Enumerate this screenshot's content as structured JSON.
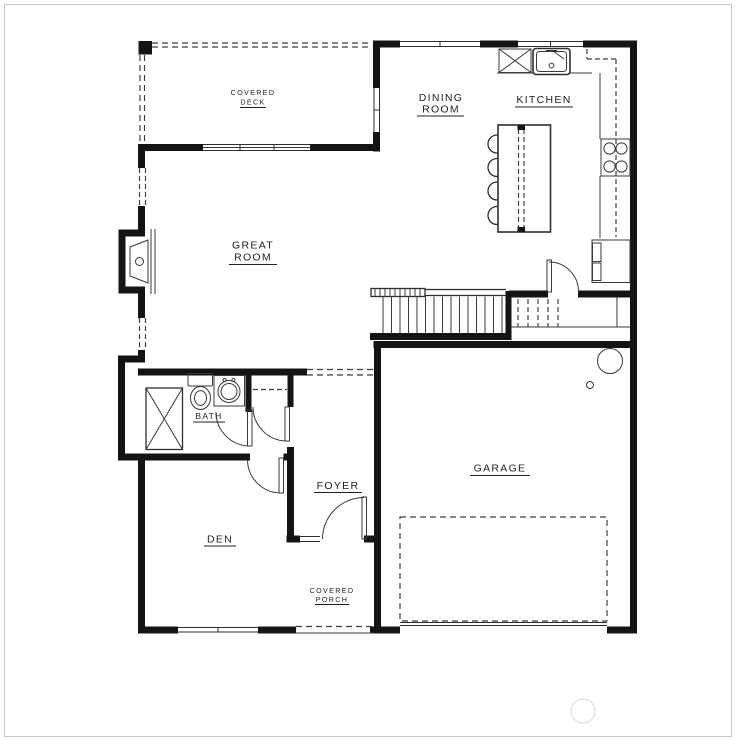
{
  "document": {
    "type": "floor-plan",
    "sheet_name": "First Floor Plan"
  },
  "colors": {
    "paper": "#ffffff",
    "wall": "#141414",
    "line": "#2e2e2e",
    "dashed": "#3f3f3f",
    "text": "#1f1f1f",
    "frame": "#c9c9c9",
    "watermark": "#e4e4e4"
  },
  "rooms": {
    "covered_deck": {
      "lines": [
        "COVERED",
        "DECK"
      ]
    },
    "dining_room": {
      "lines": [
        "DINING",
        "ROOM"
      ]
    },
    "kitchen": {
      "label": "KITCHEN"
    },
    "great_room": {
      "lines": [
        "GREAT",
        "ROOM"
      ]
    },
    "bath": {
      "label": "BATH"
    },
    "foyer": {
      "label": "FOYER"
    },
    "den": {
      "label": "DEN"
    },
    "garage": {
      "label": "GARAGE"
    },
    "covered_porch": {
      "lines": [
        "COVERED",
        "PORCH"
      ]
    }
  }
}
